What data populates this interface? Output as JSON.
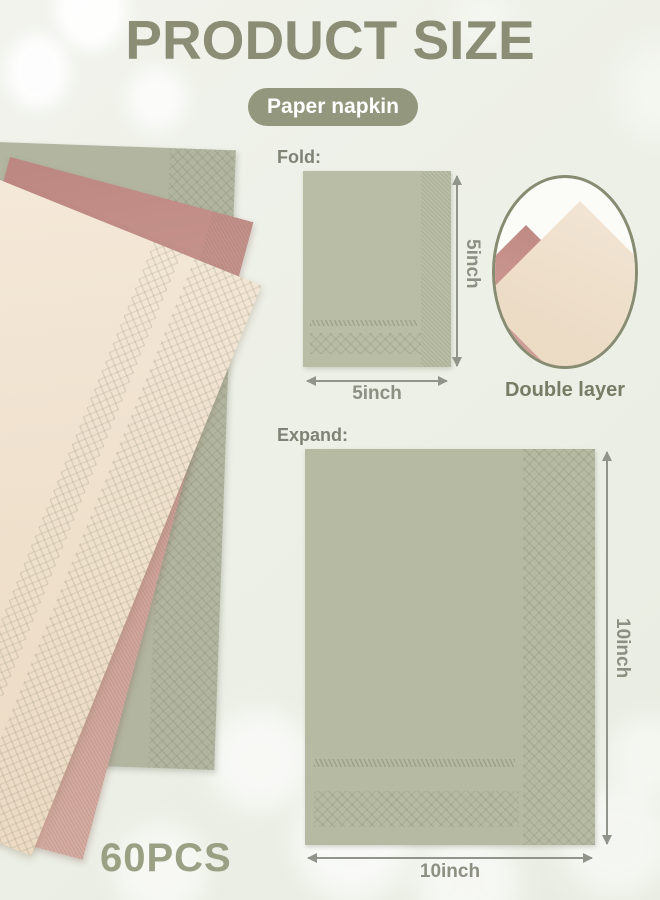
{
  "title": "PRODUCT SIZE",
  "badge": "Paper napkin",
  "fold": {
    "label": "Fold:",
    "width_label": "5inch",
    "height_label": "5inch"
  },
  "expand": {
    "label": "Expand:",
    "width_label": "10inch",
    "height_label": "10inch"
  },
  "double_layer": {
    "label": "Double layer"
  },
  "pieces": {
    "label": "60PCS"
  },
  "colors": {
    "accent_text": "#8b8e75",
    "badge_bg": "#93977d",
    "badge_text": "#ffffff",
    "napkin_sage": "#b9bda5",
    "napkin_pink": "#cd9d95",
    "napkin_cream": "#efe0cc",
    "dimension_text": "#8c9083",
    "double_layer_text": "#767c65",
    "pieces_text": "#9aa083",
    "background": "#eef0e8"
  }
}
